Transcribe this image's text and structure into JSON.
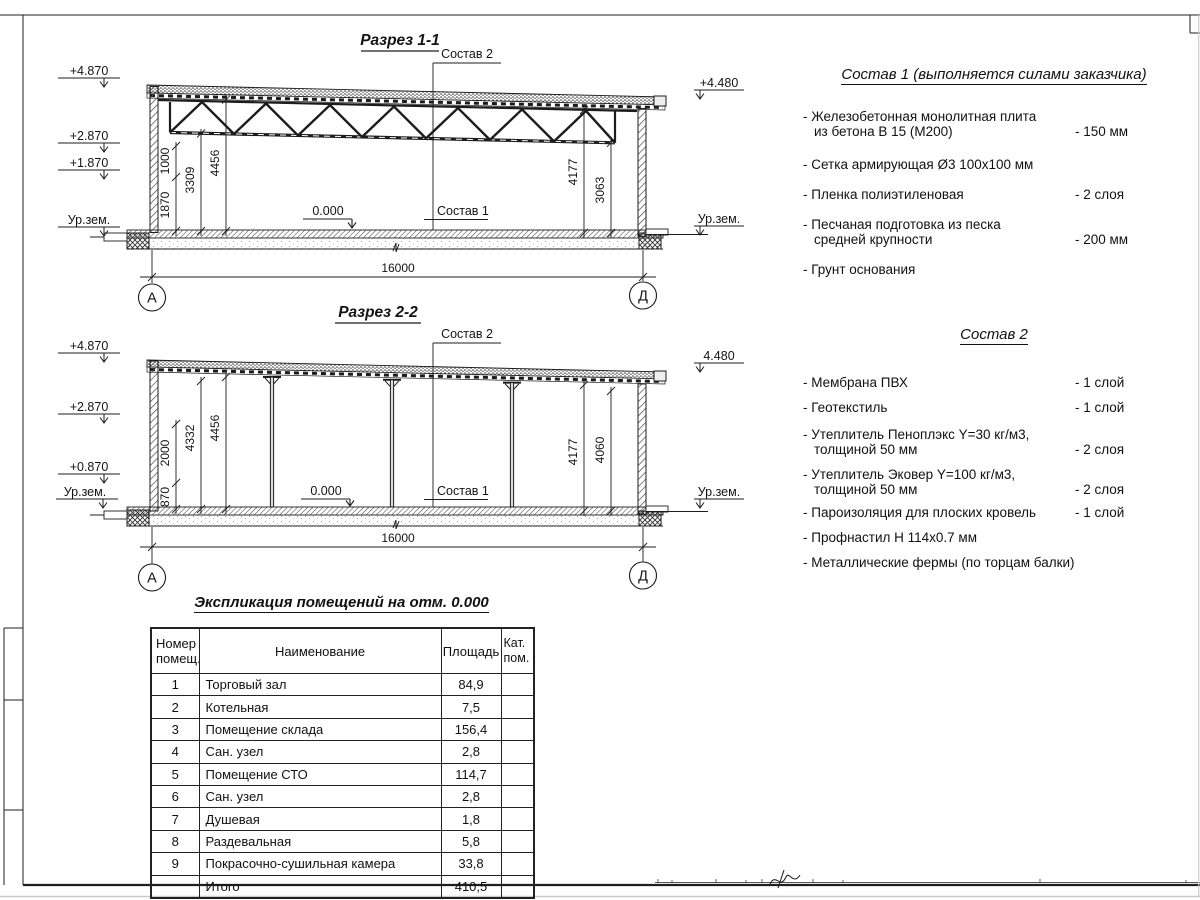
{
  "section1": {
    "title": "Разрез 1-1",
    "sostav2_label": "Состав 2",
    "sostav1_label": "Состав 1",
    "zero_level": "0.000",
    "elev_left": [
      "+4.870",
      "+2.870",
      "+1.870",
      "Ур.зем."
    ],
    "elev_right": [
      "+4.480",
      "Ур.зем."
    ],
    "dims_left": [
      "1870",
      "1000",
      "3309",
      "4456"
    ],
    "dims_right": [
      "4177",
      "3063"
    ],
    "span_dim": "16000",
    "axis_left": "А",
    "axis_right": "Д"
  },
  "section2": {
    "title": "Разрез 2-2",
    "sostav2_label": "Состав 2",
    "sostav1_label": "Состав 1",
    "zero_level": "0.000",
    "elev_left": [
      "+4.870",
      "+2.870",
      "+0.870",
      "Ур.зем."
    ],
    "elev_right": [
      "4.480",
      "Ур.зем."
    ],
    "dims_left": [
      "870",
      "2000",
      "4332",
      "4456"
    ],
    "dims_right": [
      "4177",
      "4060"
    ],
    "span_dim": "16000",
    "axis_left": "А",
    "axis_right": "Д"
  },
  "composition1": {
    "title": "Состав 1 (выполняется силами заказчика)",
    "items": [
      {
        "lines": [
          "- Железобетонная  монолитная плита",
          "из бетона В 15 (М200)"
        ],
        "value": "- 150 мм"
      },
      {
        "lines": [
          "- Сетка армирующая Ø3 100х100 мм"
        ],
        "value": ""
      },
      {
        "lines": [
          "- Пленка полиэтиленовая"
        ],
        "value": "-  2 слоя"
      },
      {
        "lines": [
          "- Песчаная подготовка из песка",
          "средней крупности"
        ],
        "value": "- 200 мм"
      },
      {
        "lines": [
          "- Грунт основания"
        ],
        "value": ""
      }
    ]
  },
  "composition2": {
    "title": "Состав 2",
    "items": [
      {
        "lines": [
          "- Мембрана ПВХ"
        ],
        "value": "- 1 слой"
      },
      {
        "lines": [
          "- Геотекстиль"
        ],
        "value": "- 1 слой"
      },
      {
        "lines": [
          "- Утеплитель Пеноплэкс Y=30 кг/м3,",
          "толщиной 50 мм"
        ],
        "value": "- 2 слоя"
      },
      {
        "lines": [
          "- Утеплитель Эковер Y=100 кг/м3,",
          "толщиной 50 мм"
        ],
        "value": "- 2 слоя"
      },
      {
        "lines": [
          "- Пароизоляция для плоских кровель"
        ],
        "value": "- 1 слой"
      },
      {
        "lines": [
          "- Профнастил Н 114х0.7 мм"
        ],
        "value": ""
      },
      {
        "lines": [
          "- Металлические фермы (по торцам балки)"
        ],
        "value": ""
      }
    ]
  },
  "room_table": {
    "title": "Экспликация помещений на отм. 0.000",
    "headers": [
      "Номер помещ.",
      "Наименование",
      "Площадь",
      "Кат. пом."
    ],
    "rows": [
      [
        "1",
        "Торговый зал",
        "84,9",
        ""
      ],
      [
        "2",
        "Котельная",
        "7,5",
        ""
      ],
      [
        "3",
        "Помещение склада",
        "156,4",
        ""
      ],
      [
        "4",
        "Сан. узел",
        "2,8",
        ""
      ],
      [
        "5",
        "Помещение СТО",
        "114,7",
        ""
      ],
      [
        "6",
        "Сан. узел",
        "2,8",
        ""
      ],
      [
        "7",
        "Душевая",
        "1,8",
        ""
      ],
      [
        "8",
        "Раздевальная",
        "5,8",
        ""
      ],
      [
        "9",
        "Покрасочно-сушильная камера",
        "33,8",
        ""
      ],
      [
        "",
        "Итого",
        "410,5",
        ""
      ]
    ]
  }
}
